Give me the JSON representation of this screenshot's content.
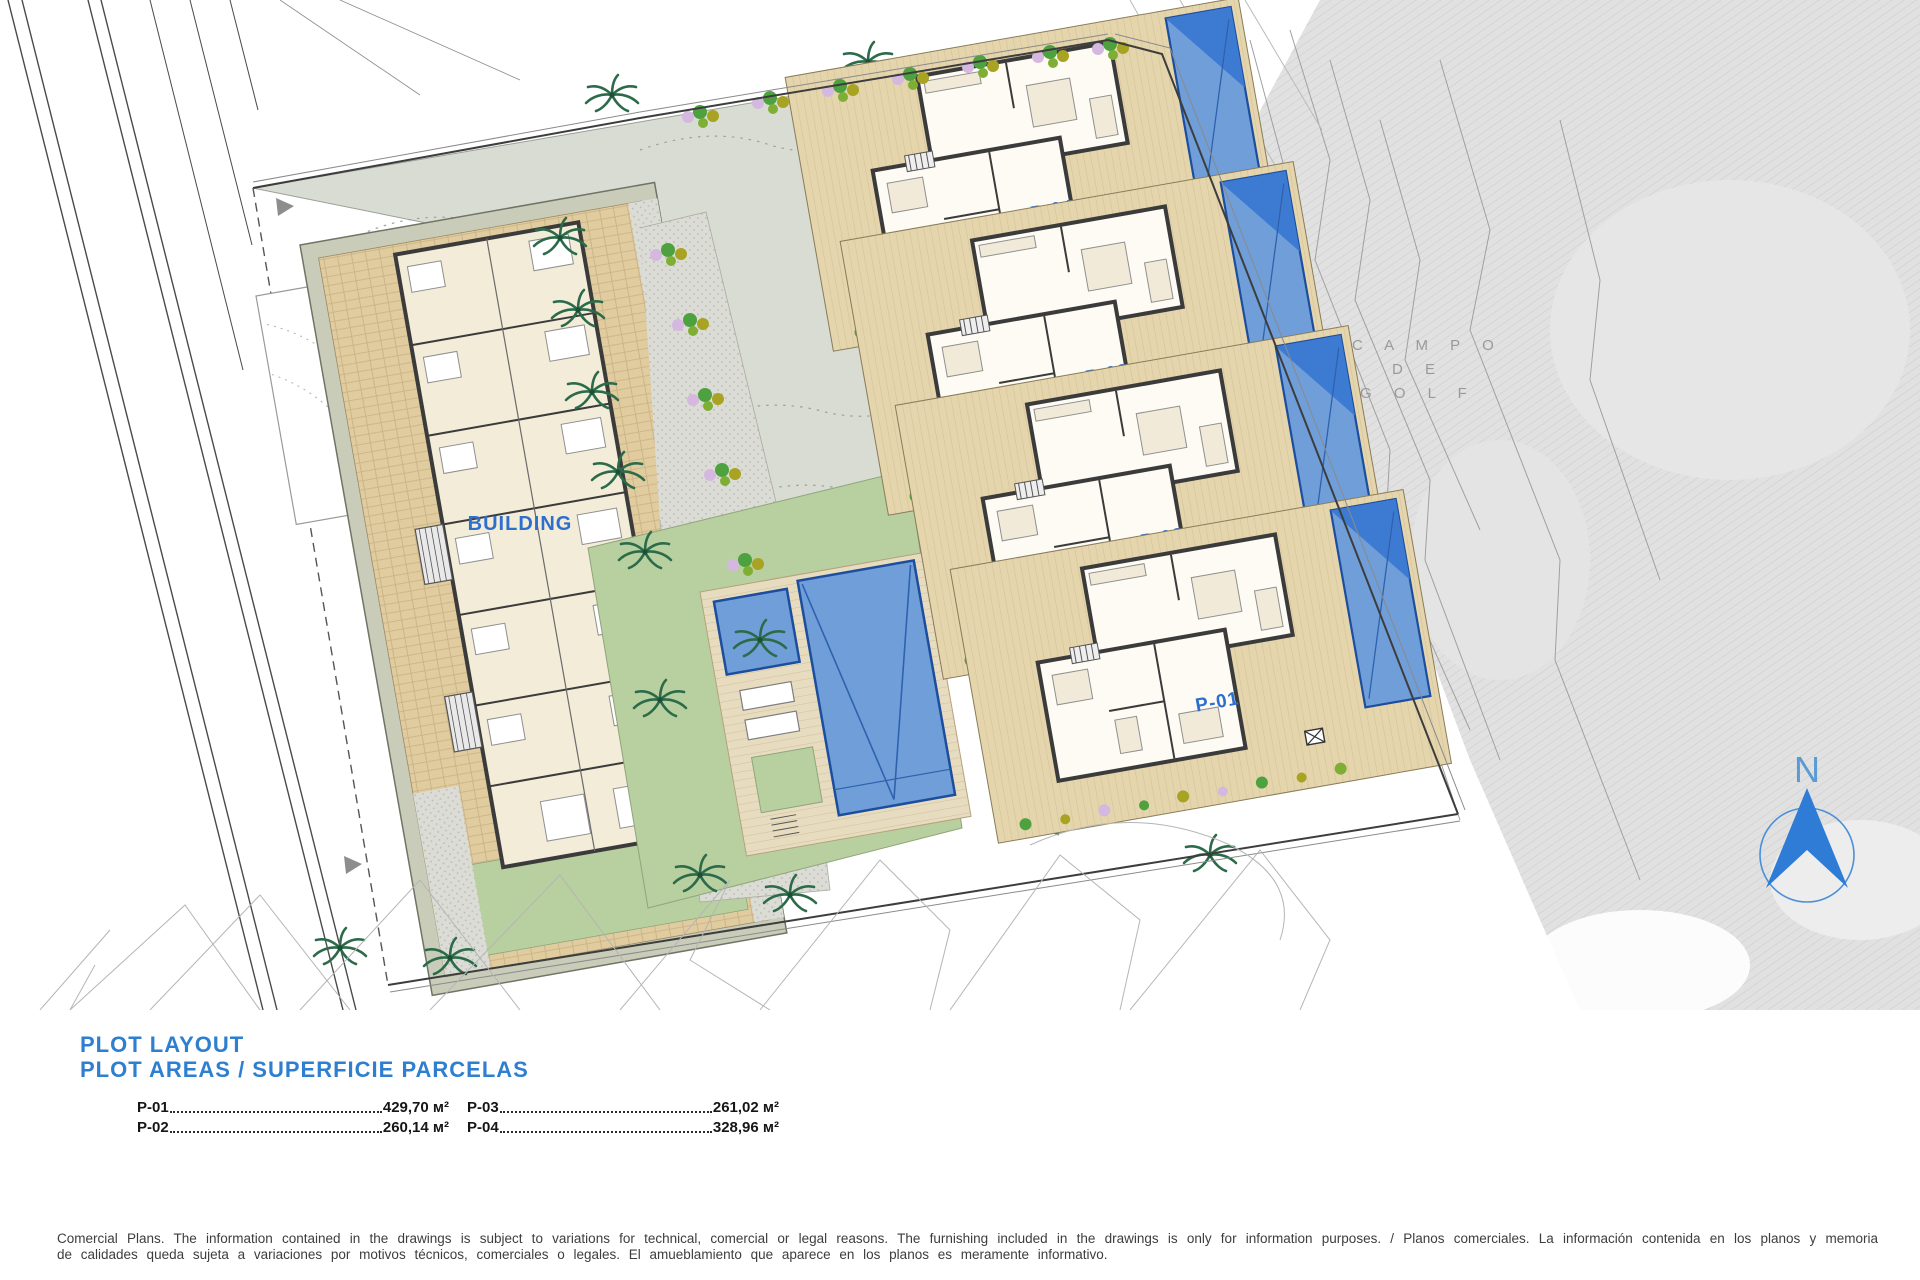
{
  "plan": {
    "building_label": "BUILDING",
    "plot_labels": {
      "p01": "P-01",
      "p02": "P-02",
      "p03": "P-03",
      "p04": "P-04"
    },
    "golf_label": {
      "line1": "C A M P O",
      "line2": "D E",
      "line3": "G O L F"
    },
    "north_label": "N",
    "colors": {
      "accent_blue": "#2e7fd0",
      "pool_blue": "#6f9ed9",
      "pool_dark": "#3d7bd3",
      "terrace_tan": "#e5d5ac",
      "paving_tan": "#e0cc9e",
      "lawn_green": "#b8cf9f",
      "driveway_sage": "#d8dcd3",
      "band_sage": "#c9ccb8",
      "golf_gray": "#e1e1e1",
      "plant_green": "#4da23f",
      "plant_olive": "#a8a322",
      "plant_lilac": "#d5b8e0",
      "palm_green": "#2c6b4a",
      "wall_dark": "#3b3b3b"
    }
  },
  "legend": {
    "title": "PLOT LAYOUT",
    "subtitle": "PLOT AREAS / SUPERFICIE PARCELAS",
    "areas": [
      {
        "label": "P-01",
        "value": "429,70 м²"
      },
      {
        "label": "P-03",
        "value": "261,02 м²"
      },
      {
        "label": "P-02",
        "value": "260,14 м²"
      },
      {
        "label": "P-04",
        "value": "328,96 м²"
      }
    ]
  },
  "disclaimer": "Comercial Plans. The information contained in the drawings is subject to variations for technical, comercial or legal reasons. The furnishing included in the drawings is only for information purposes. / Planos comerciales. La información contenida en los planos y memoria de calidades queda sujeta a variaciones por motivos técnicos, comerciales o legales. El amueblamiento que aparece en los planos es meramente informativo."
}
